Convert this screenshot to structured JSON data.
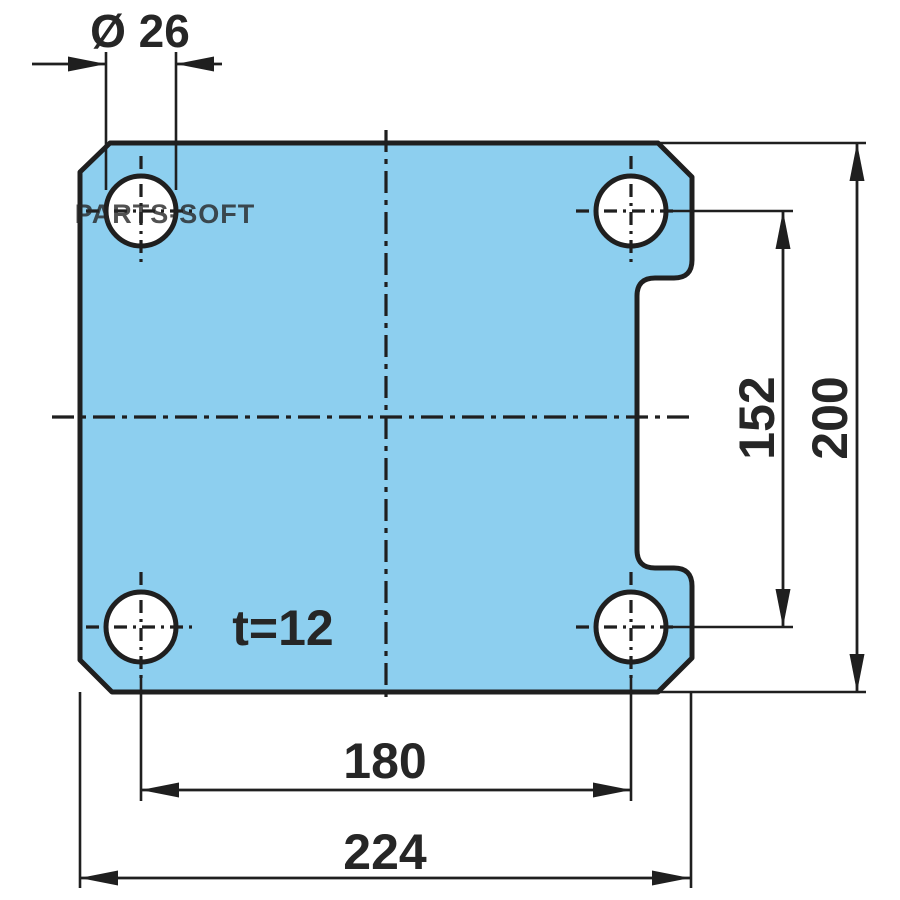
{
  "drawing": {
    "kind": "technical-drawing-plate-top-view",
    "labels": {
      "hole_diameter": "Ø 26",
      "hole_spacing_vertical": "152",
      "plate_height": "200",
      "hole_spacing_horizontal": "180",
      "plate_width": "224",
      "thickness": "t=12"
    },
    "values": {
      "hole_diameter_mm": 26,
      "hole_spacing_vertical_mm": 152,
      "plate_height_mm": 200,
      "hole_spacing_horizontal_mm": 180,
      "plate_width_mm": 224,
      "thickness_mm": 12,
      "hole_count": 4
    },
    "watermark": "PARTS-SOFT",
    "colors": {
      "plate_fill": "#8DCFEF",
      "line": "#1F1F1F",
      "dim_text": "#262626",
      "watermark_gray": "#8E979C"
    }
  }
}
